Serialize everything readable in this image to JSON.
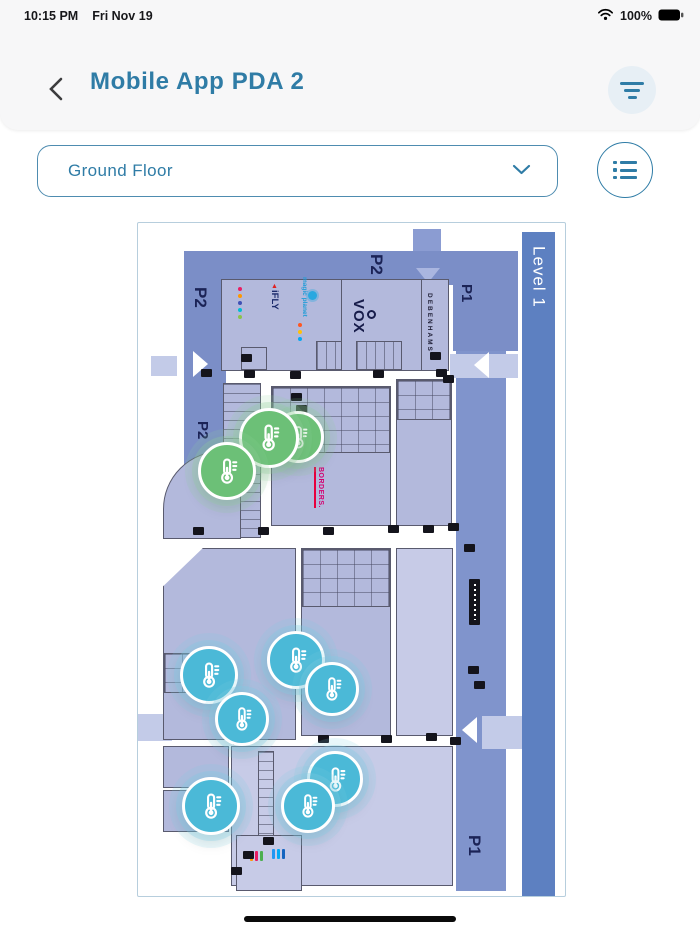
{
  "colors": {
    "accent": "#2f7ca6",
    "marker_green": "#6cc077",
    "marker_blue": "#4bb9d7",
    "parking_band": "#7b8ec7",
    "store_fill": "#b3b9dc",
    "level_strip": "#5d80c1"
  },
  "status_bar": {
    "time": "10:15 PM",
    "date": "Fri Nov 19",
    "battery_percent": "100%"
  },
  "header": {
    "title": "Mobile App PDA 2"
  },
  "controls": {
    "floor_selector_value": "Ground Floor"
  },
  "map": {
    "level_label": "Level 1",
    "zone_labels": [
      {
        "text": "P2",
        "position": "top"
      },
      {
        "text": "P2",
        "position": "left-upper"
      },
      {
        "text": "P2",
        "position": "left-lower"
      },
      {
        "text": "P1",
        "position": "right-upper"
      },
      {
        "text": "P1",
        "position": "bottom-right"
      }
    ],
    "store_labels": [
      {
        "name": "iFLY"
      },
      {
        "name": "magic planet"
      },
      {
        "name": "VOX"
      },
      {
        "name": "DEBENHAMS"
      },
      {
        "name": "BORDERS."
      }
    ],
    "markers": [
      {
        "type": "temperature",
        "status": "green",
        "x": 160,
        "y": 214,
        "r": 26
      },
      {
        "type": "temperature",
        "status": "green",
        "x": 131,
        "y": 215,
        "r": 30
      },
      {
        "type": "temperature",
        "status": "green",
        "x": 89,
        "y": 248,
        "r": 29
      },
      {
        "type": "temperature",
        "status": "blue",
        "x": 71,
        "y": 452,
        "r": 29
      },
      {
        "type": "temperature",
        "status": "blue",
        "x": 158,
        "y": 437,
        "r": 29
      },
      {
        "type": "temperature",
        "status": "blue",
        "x": 194,
        "y": 466,
        "r": 27
      },
      {
        "type": "temperature",
        "status": "blue",
        "x": 104,
        "y": 496,
        "r": 27
      },
      {
        "type": "temperature",
        "status": "blue",
        "x": 197,
        "y": 556,
        "r": 28
      },
      {
        "type": "temperature",
        "status": "blue",
        "x": 170,
        "y": 583,
        "r": 27
      },
      {
        "type": "temperature",
        "status": "blue",
        "x": 73,
        "y": 583,
        "r": 29
      }
    ]
  }
}
